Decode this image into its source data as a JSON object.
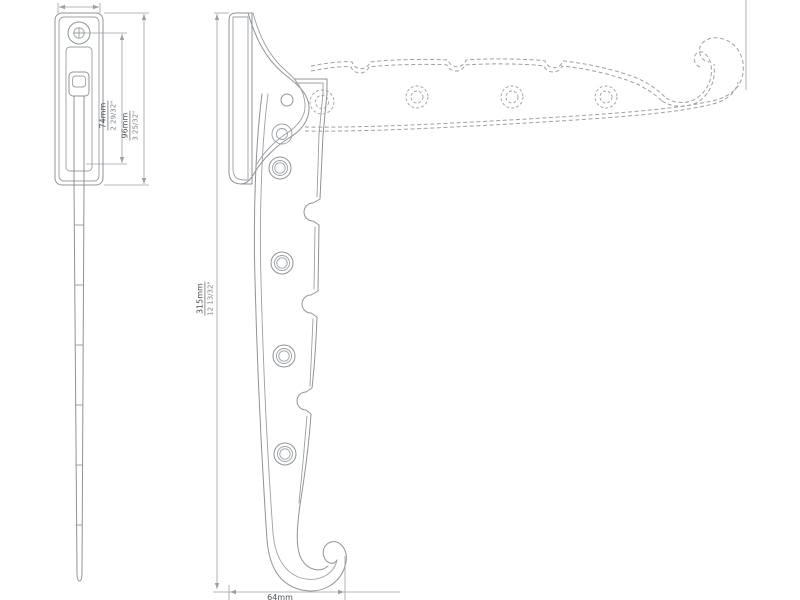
{
  "drawing": {
    "kind": "technical-orthographic-drawing",
    "subject": "folding wall hook bracket",
    "colors": {
      "background": "#ffffff",
      "line": "#8f9397",
      "dashed_line": "#9aa1a7",
      "dimension_line": "#9aa1a7",
      "text": "#4d5257",
      "text_secondary": "#7d838a"
    }
  },
  "side_view": {
    "plate_width_dim": {
      "mm": "24mm"
    },
    "screw_to_pivot_dim": {
      "mm": "74mm",
      "inch": "2 29/32\""
    },
    "plate_height_dim": {
      "mm": "96mm",
      "inch": "3 25/32\""
    }
  },
  "front_view": {
    "overall_height_dim": {
      "mm": "315mm",
      "inch": "12 13/32\""
    },
    "hook_width_dim": {
      "mm": "64mm"
    }
  }
}
